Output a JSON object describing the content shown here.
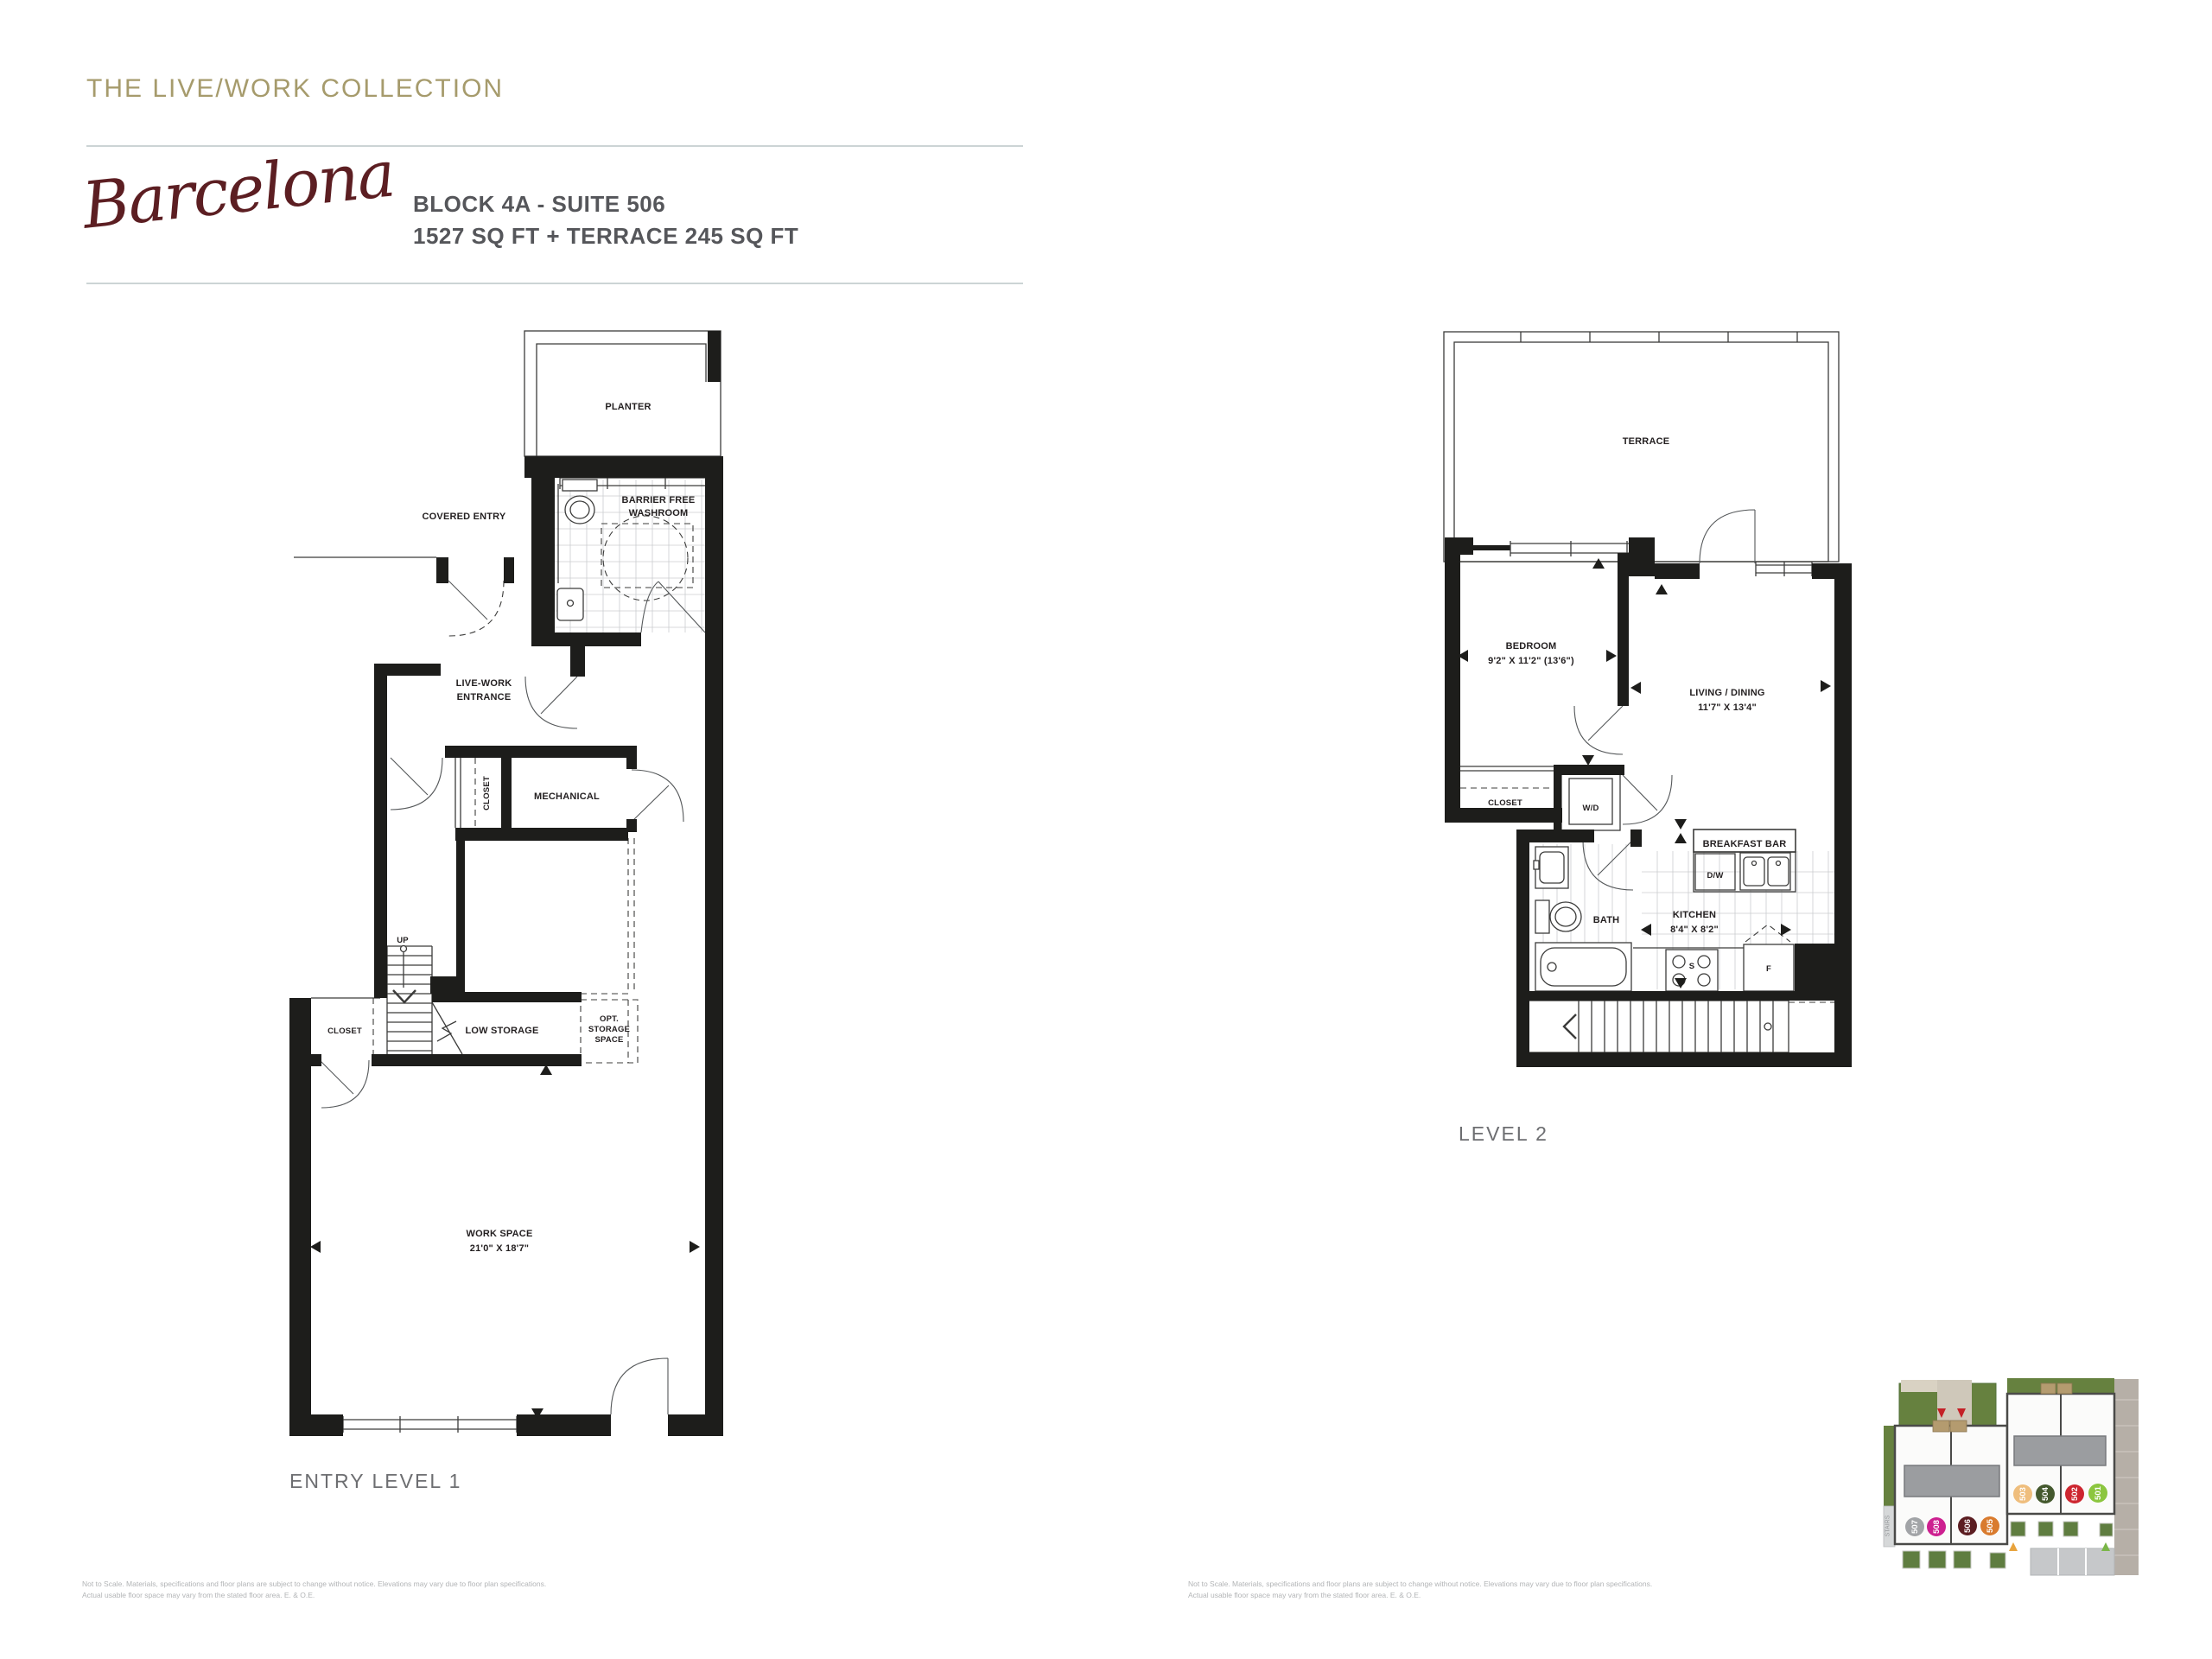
{
  "page": {
    "collection_title": "THE LIVE/WORK COLLECTION",
    "model_name": "Barcelona",
    "suite_line1": "BLOCK 4A - SUITE 506",
    "suite_line2": "1527 SQ FT + TERRACE 245 SQ FT",
    "disclaimer_line1": "Not to Scale. Materials, specifications and floor plans are subject to change without notice.  Elevations may vary due to floor plan specifications.",
    "disclaimer_line2": "Actual usable floor space may vary from the stated floor area. E. & O.E."
  },
  "level1": {
    "caption": "ENTRY LEVEL 1",
    "labels": {
      "planter": "PLANTER",
      "covered_entry": "COVERED ENTRY",
      "washroom_line1": "BARRIER FREE",
      "washroom_line2": "WASHROOM",
      "entrance_line1": "LIVE-WORK",
      "entrance_line2": "ENTRANCE",
      "closet_upper": "CLOSET",
      "mechanical": "MECHANICAL",
      "up": "UP",
      "closet_lower": "CLOSET",
      "low_storage": "LOW STORAGE",
      "opt_line1": "OPT.",
      "opt_line2": "STORAGE",
      "opt_line3": "SPACE",
      "workspace": "WORK SPACE",
      "workspace_dim": "21'0\" X 18'7\""
    }
  },
  "level2": {
    "caption": "LEVEL 2",
    "labels": {
      "terrace": "TERRACE",
      "bedroom": "BEDROOM",
      "bedroom_dim": "9'2\" X 11'2\" (13'6\")",
      "living": "LIVING / DINING",
      "living_dim": "11'7\" X 13'4\"",
      "closet": "CLOSET",
      "washer_dryer": "W/D",
      "breakfast_bar": "BREAKFAST BAR",
      "dishwasher": "D/W",
      "bath": "BATH",
      "kitchen": "KITCHEN",
      "kitchen_dim": "8'4\" X 8'2\"",
      "stove": "S",
      "fridge": "F"
    }
  },
  "keyplan": {
    "stairs_label": "STAIRS",
    "locator_arrow_color": "#c42127",
    "units": [
      {
        "number": "507",
        "color": "#a2a4a7"
      },
      {
        "number": "508",
        "color": "#cd2090"
      },
      {
        "number": "506",
        "color": "#5c1e22"
      },
      {
        "number": "505",
        "color": "#d97b2e"
      },
      {
        "number": "503",
        "color": "#efbe7d"
      },
      {
        "number": "504",
        "color": "#44592e"
      },
      {
        "number": "502",
        "color": "#cd2630"
      },
      {
        "number": "501",
        "color": "#8cc63f"
      }
    ]
  },
  "colors": {
    "title_tan": "#a69b6c",
    "script_maroon": "#5c1e22",
    "heading_gray": "#55565a",
    "caption_gray": "#6d6e71",
    "disclaimer_gray": "#b2b4b6",
    "rule_gray": "#ccd4d5",
    "plan_black": "#1d1d1b"
  }
}
